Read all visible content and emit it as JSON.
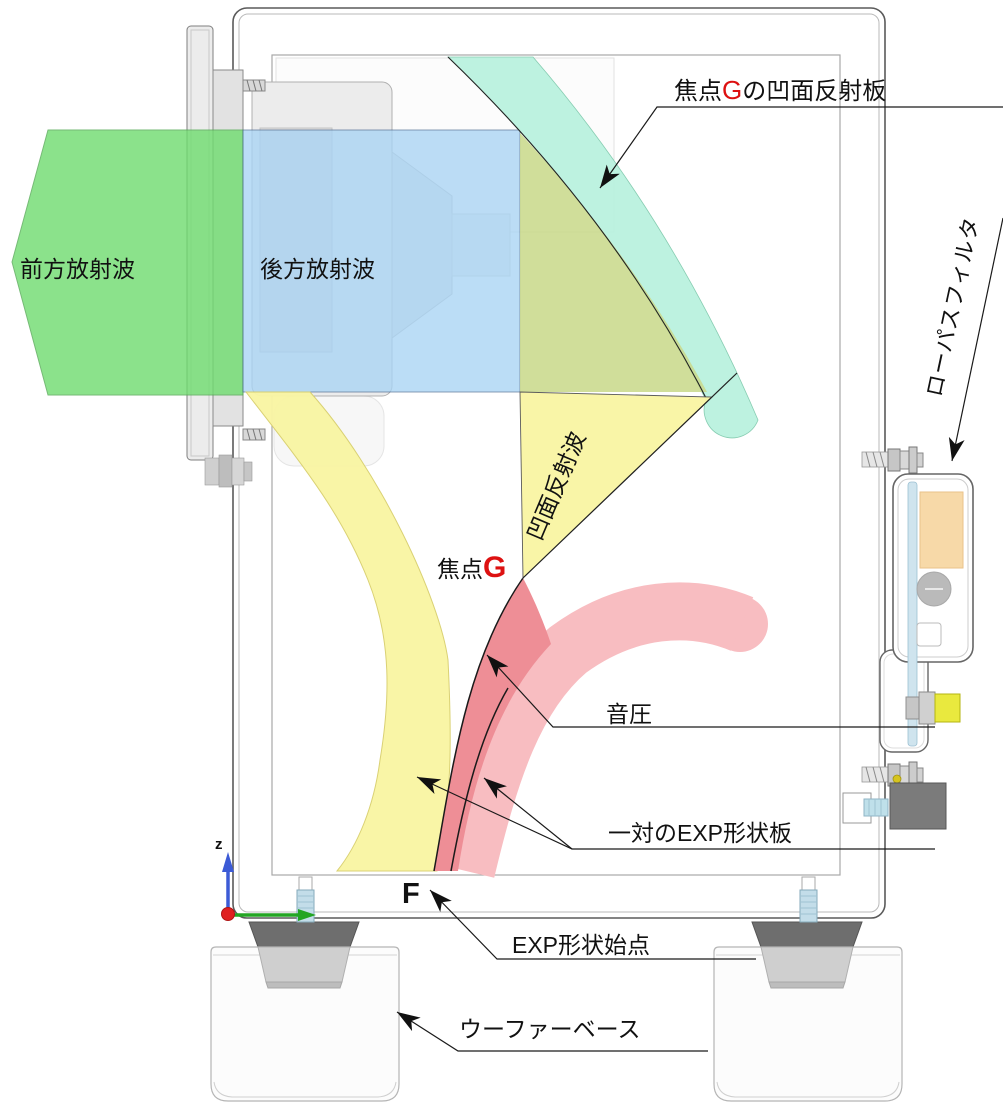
{
  "labels": {
    "reflector": {
      "p1": "焦点",
      "g": "G",
      "p2": "の凹面反射板"
    },
    "front_wave": "前方放射波",
    "rear_wave": "後方放射波",
    "concave_wave": "凹面反射波",
    "focus": {
      "p1": "焦点",
      "g": "G"
    },
    "sound_pressure": "音圧",
    "exp_pair": "一対のEXP形状板",
    "exp_start": "EXP形状始点",
    "point_f": "F",
    "woofer_base": "ウーファーベース",
    "lowpass": "ローパスフィルタ",
    "axis_z": "z"
  },
  "colors": {
    "front_wave": "#6fdc6f",
    "rear_wave": "#a9d4f4",
    "reflector": "#b9f2de",
    "overlap_olive": "#c9d98c",
    "reflected_wave": "#f9f5a4",
    "pressure_band": "#f8bdc1",
    "pressure_core": "#ee8e96",
    "focus_red": "#dd1111",
    "axis_x": "#23a523",
    "axis_z": "#3c5bd6",
    "origin": "#e02020",
    "leader": "#1a1a1a"
  }
}
